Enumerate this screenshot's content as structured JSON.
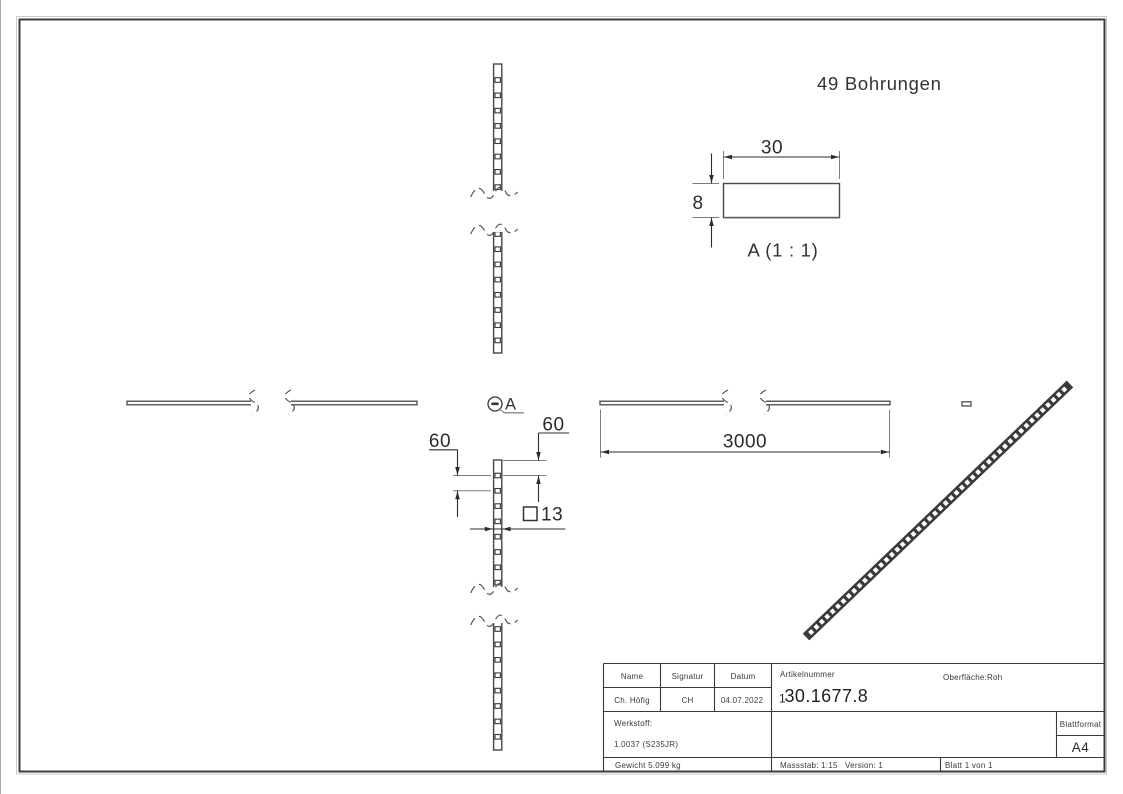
{
  "drawing": {
    "note_bohrungen": "49 Bohrungen",
    "detail": {
      "label": "A",
      "title": "A (1 : 1)",
      "width_dim": "30",
      "height_dim": "8"
    },
    "dims": {
      "length": "3000",
      "end_offset": "60",
      "pitch": "60",
      "hole_size": "13",
      "square_symbol": "□"
    },
    "callout_label": "A"
  },
  "title_block": {
    "headers": {
      "name": "Name",
      "signatur": "Signatur",
      "datum": "Datum",
      "artikelnummer": "Artikelnummer",
      "oberflaeche": "Oberfläche:",
      "werkstoff": "Werkstoff:",
      "blattformat": "Blattformat"
    },
    "name": "Ch. Höfig",
    "signatur": "CH",
    "datum": "04.07.2022",
    "artikelnummer_prefix": "1",
    "artikelnummer_main": "30.1677.8",
    "oberflaeche_value": "Roh",
    "werkstoff_value": "1.0037 (S235JR)",
    "blattformat_value": "A4",
    "gewicht": "Gewicht 5.099 kg",
    "massstab": "Massstab: 1:15",
    "version": "Version: 1",
    "blatt": "Blatt 1 von 1"
  },
  "colors": {
    "model_line": "#474747",
    "dim_line": "#2c2c2c",
    "frame": "#3c3c3c",
    "iso_fill": "#3a3a3a"
  },
  "geometry": {
    "vertical_bar": {
      "x": 493.6,
      "w": 8.2,
      "segments": [
        {
          "y1": 64,
          "y2": 192,
          "break": "bottom",
          "hole_start": 80,
          "hole_step": 15.3,
          "hole_count": 8
        },
        {
          "y1": 231,
          "y2": 353,
          "break": "top",
          "hole_start": 234,
          "hole_step": 15.2,
          "hole_count": 8
        },
        {
          "y1": 460,
          "y2": 588,
          "break": "bottom",
          "hole_start": 475.5,
          "hole_step": 15.3,
          "hole_count": 8
        },
        {
          "y1": 622,
          "y2": 750,
          "break": "top",
          "hole_start": 629,
          "hole_step": 15.4,
          "hole_count": 8
        }
      ]
    },
    "horizontal_bar": {
      "y": 401.2,
      "h": 3.6,
      "segments": [
        {
          "x1": 127,
          "x2": 252,
          "break": "right"
        },
        {
          "x1": 290,
          "x2": 417,
          "break": "left"
        },
        {
          "x1": 600,
          "x2": 725,
          "break": "right"
        },
        {
          "x1": 765,
          "x2": 890,
          "break": "left"
        }
      ]
    },
    "end_dash": {
      "x": 962,
      "y": 401.8,
      "w": 9,
      "h": 4.2
    },
    "iso_bar": {
      "x1": 806,
      "y1": 637,
      "x2": 1070,
      "y2": 384,
      "width": 9.4,
      "hole_count": 49
    }
  }
}
